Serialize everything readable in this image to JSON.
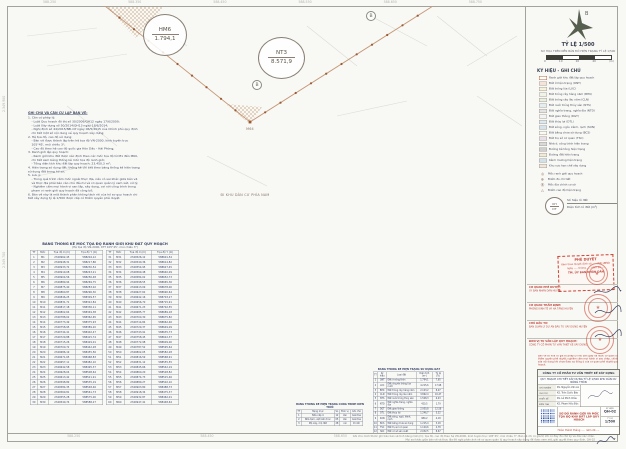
{
  "sheet": {
    "code": "QH-02"
  },
  "map": {
    "top_coords": [
      "588.250",
      "588.350",
      "588.450",
      "588.550",
      "588.650",
      "588.750"
    ],
    "bottom_coords": [
      "588.250",
      "588.450",
      "588.650"
    ],
    "left_coords": [
      "2.349.900",
      "2.349.700"
    ],
    "lots": [
      {
        "id": "HM6",
        "area": "1.794,1"
      },
      {
        "id": "NT3",
        "area": "8.571,9"
      }
    ],
    "vertex_label": "M64",
    "benchmark_label": "B",
    "road_label": "ĐI KHU DÂN CƯ PHÍA NAM"
  },
  "notes": {
    "title": "GHI CHÚ VÀ CĂN CỨ LẬP BẢN VẼ:",
    "lines": [
      {
        "text": "1. Căn cứ pháp lý:",
        "pad": "0px"
      },
      {
        "text": "- Luật Quy hoạch đô thị số 30/2009/QH12 ngày 17/6/2009;",
        "pad": "7px"
      },
      {
        "text": "- Luật Xây dựng số 50/2014/QH13 ngày 18/6/2014;",
        "pad": "7px"
      },
      {
        "text": "- Nghị định số 44/2015/NĐ-CP ngày 06/5/2015 của Chính phủ quy định chi tiết một số nội dung về quy hoạch xây dựng;",
        "pad": "7px"
      },
      {
        "text": "2. Hệ tọa độ, cao độ sử dụng:",
        "pad": "0px"
      },
      {
        "text": "- Bản vẽ được thành lập trên hệ tọa độ VN-2000, kinh tuyến trục 105°45', múi chiếu 3°;",
        "pad": "7px"
      },
      {
        "text": "- Cao độ theo hệ cao độ quốc gia Hòn Dấu - Hải Phòng;",
        "pad": "7px"
      },
      {
        "text": "3. Ranh giới lập quy hoạch:",
        "pad": "0px"
      },
      {
        "text": "- Ranh giới khu đất được xác định theo các mốc tọa độ từ M1 đến M60, chi tiết xem bảng thống kê mốc tọa độ ranh giới;",
        "pad": "7px"
      },
      {
        "text": "- Tổng diện tích khu đất lập quy hoạch: 23.450,3 m²;",
        "pad": "7px"
      },
      {
        "text": "4. Hiện trạng sử dụng đất: thống kê chi tiết theo bảng thống kê hiện trạng sử dụng đất trong hồ sơ;",
        "pad": "0px"
      },
      {
        "text": "5. Lưu ý:",
        "pad": "0px"
      },
      {
        "text": "- Trong quá trình cắm mốc ngoài thực địa, nếu có sai khác giữa bản vẽ và thực địa phải báo cáo chủ đầu tư và cơ quan quản lý xem xét, xử lý;",
        "pad": "7px"
      },
      {
        "text": "- Nghiêm cấm mọi hành vi san lấp, xây dựng, cơi nới công trình trong phạm vi ranh giới quy hoạch đã công bố;",
        "pad": "7px"
      },
      {
        "text": "6. Bản vẽ này là một thành phần không tách rời của hồ sơ quy hoạch chi tiết xây dựng tỷ lệ 1/500 được cấp có thẩm quyền phê duyệt.",
        "pad": "0px"
      }
    ]
  },
  "coord_table": {
    "title": "BẢNG THỐNG KÊ MỐC TỌA ĐỘ RANH GIỚI KHU ĐẤT QUY HOẠCH",
    "subtitle": "(Hệ tọa độ VN-2000, KTT 105°45', múi chiếu 3°)",
    "headers": [
      "TT",
      "Mốc",
      "Tọa độ X (m)",
      "Tọa độ Y (m)"
    ],
    "left": [
      [
        "1",
        "M1",
        "2349962,45",
        "588204,12"
      ],
      [
        "2",
        "M2",
        "2349948,31",
        "588217,86"
      ],
      [
        "3",
        "M3",
        "2349933,72",
        "588230,54"
      ],
      [
        "4",
        "M4",
        "2349919,08",
        "588243,21"
      ],
      [
        "5",
        "M5",
        "2349904,56",
        "588256,48"
      ],
      [
        "6",
        "M6",
        "2349889,94",
        "588269,75"
      ],
      [
        "7",
        "M7",
        "2349875,40",
        "588283,02"
      ],
      [
        "8",
        "M8",
        "2349860,87",
        "588296,30"
      ],
      [
        "9",
        "M9",
        "2349846,25",
        "588309,57"
      ],
      [
        "10",
        "M10",
        "2349831,71",
        "588322,84"
      ],
      [
        "11",
        "M11",
        "2349817,18",
        "588336,11"
      ],
      [
        "12",
        "M12",
        "2349802,64",
        "588349,38"
      ],
      [
        "13",
        "M13",
        "2349788,02",
        "588362,65"
      ],
      [
        "14",
        "M14",
        "2349773,49",
        "588375,93"
      ],
      [
        "15",
        "M15",
        "2349758,95",
        "588389,20"
      ],
      [
        "16",
        "M16",
        "2349744,41",
        "588402,47"
      ],
      [
        "17",
        "M17",
        "2349729,88",
        "588415,74"
      ],
      [
        "18",
        "M18",
        "2349715,26",
        "588429,01"
      ],
      [
        "19",
        "M19",
        "2349700,72",
        "588442,28"
      ],
      [
        "20",
        "M20",
        "2349686,19",
        "588455,56"
      ],
      [
        "21",
        "M21",
        "2349671,65",
        "588468,83"
      ],
      [
        "22",
        "M22",
        "2349657,11",
        "588482,10"
      ],
      [
        "23",
        "M23",
        "2349642,58",
        "588495,37"
      ],
      [
        "24",
        "M24",
        "2349628,04",
        "588508,64"
      ],
      [
        "25",
        "M25",
        "2349613,42",
        "588521,91"
      ],
      [
        "26",
        "M26",
        "2349598,89",
        "588535,19"
      ],
      [
        "27",
        "M27",
        "2349584,35",
        "588548,46"
      ],
      [
        "28",
        "M28",
        "2349569,81",
        "588561,73"
      ],
      [
        "29",
        "M29",
        "2349555,28",
        "588575,00"
      ],
      [
        "30",
        "M30",
        "2349540,74",
        "588588,27"
      ]
    ],
    "right": [
      [
        "31",
        "M31",
        "2349526,12",
        "588601,54"
      ],
      [
        "32",
        "M32",
        "2349540,36",
        "588614,82"
      ],
      [
        "33",
        "M33",
        "2349554,95",
        "588627,45"
      ],
      [
        "34",
        "M34",
        "2349569,48",
        "588640,09"
      ],
      [
        "35",
        "M35",
        "2349584,02",
        "588652,73"
      ],
      [
        "36",
        "M36",
        "2349598,55",
        "588665,36"
      ],
      [
        "37",
        "M37",
        "2349613,09",
        "588678,00"
      ],
      [
        "38",
        "M38",
        "2349627,62",
        "588690,64"
      ],
      [
        "39",
        "M39",
        "2349642,16",
        "588703,27"
      ],
      [
        "40",
        "M40",
        "2349656,70",
        "588715,91"
      ],
      [
        "41",
        "M41",
        "2349671,23",
        "588702,55"
      ],
      [
        "42",
        "M42",
        "2349685,77",
        "588689,18"
      ],
      [
        "43",
        "M43",
        "2349700,30",
        "588675,82"
      ],
      [
        "44",
        "M44",
        "2349714,84",
        "588662,46"
      ],
      [
        "45",
        "M45",
        "2349729,37",
        "588649,09"
      ],
      [
        "46",
        "M46",
        "2349743,91",
        "588635,73"
      ],
      [
        "47",
        "M47",
        "2349758,45",
        "588622,37"
      ],
      [
        "48",
        "M48",
        "2349772,98",
        "588609,00"
      ],
      [
        "49",
        "M49",
        "2349787,52",
        "588595,64"
      ],
      [
        "50",
        "M50",
        "2349802,05",
        "588582,28"
      ],
      [
        "51",
        "M51",
        "2349816,59",
        "588568,91"
      ],
      [
        "52",
        "M52",
        "2349831,12",
        "588555,55"
      ],
      [
        "53",
        "M53",
        "2349845,66",
        "588542,19"
      ],
      [
        "54",
        "M54",
        "2349860,20",
        "588528,82"
      ],
      [
        "55",
        "M55",
        "2349874,73",
        "588515,46"
      ],
      [
        "56",
        "M56",
        "2349889,27",
        "588502,10"
      ],
      [
        "57",
        "M57",
        "2349903,80",
        "588488,73"
      ],
      [
        "58",
        "M58",
        "2349918,34",
        "588475,37"
      ],
      [
        "59",
        "M59",
        "2349932,87",
        "588462,01"
      ],
      [
        "60",
        "M60",
        "2349947,41",
        "588448,64"
      ]
    ]
  },
  "structures_table": {
    "title": "BẢNG THỐNG KÊ HIỆN TRẠNG CÔNG TRÌNH KIẾN TRÚC",
    "headers": [
      "TT",
      "Hạng mục",
      "SL",
      "Đơn vị",
      "Ghi chú"
    ],
    "rows": [
      [
        "1",
        "Nhà cấp 4",
        "12",
        "căn",
        "Giải tỏa"
      ],
      [
        "2",
        "Nhà tạm, vật kiến trúc",
        "05",
        "căn",
        "Giải tỏa"
      ],
      [
        "3",
        "Mộ xây, mộ đất",
        "28",
        "cái",
        "Di dời"
      ]
    ]
  },
  "landuse_table": {
    "title": "BẢNG THỐNG KÊ HIỆN TRẠNG SỬ DỤNG ĐẤT",
    "headers": [
      "TT",
      "Ký hiệu",
      "Loại đất",
      "Diện tích (m²)",
      "Tỷ lệ (%)"
    ],
    "rows": [
      [
        "1",
        "ONT",
        "Đất ở nông thôn",
        "1.794,1",
        "7,65"
      ],
      [
        "2",
        "LUC",
        "Đất chuyên trồng lúa nước",
        "4.215,6",
        "17,98"
      ],
      [
        "3",
        "BHK",
        "Đất trồng cây hàng năm",
        "2.103,2",
        "8,97"
      ],
      [
        "4",
        "CLN",
        "Đất trồng cây lâu năm",
        "3.862,4",
        "16,47"
      ],
      [
        "5",
        "NTS",
        "Đất nuôi trồng thủy sản",
        "1.508,3",
        "6,43"
      ],
      [
        "6",
        "NTD",
        "Đất nghĩa trang, nghĩa địa",
        "420,5",
        "1,79"
      ],
      [
        "7",
        "DGT",
        "Đất giao thông",
        "2.950,8",
        "12,58"
      ],
      [
        "8",
        "DTL",
        "Đất thủy lợi",
        "1.246,7",
        "5,32"
      ],
      [
        "9",
        "SON",
        "Đất sông, ngòi, kênh, rạch",
        "980,2",
        "4,18"
      ],
      [
        "10",
        "BCS",
        "Đất bằng chưa sử dụng",
        "1.215,4",
        "5,18"
      ],
      [
        "11",
        "TSC",
        "Đất trụ sở cơ quan",
        "1.120,6",
        "4,78"
      ],
      [
        "12",
        "SKC",
        "Đất cơ sở sản xuất",
        "2.032,5",
        "8,67"
      ]
    ],
    "total": [
      "",
      "",
      "TỔNG CỘNG",
      "23.450,3",
      "100,00"
    ]
  },
  "panel": {
    "north_label": "B",
    "scale_title": "TỶ LỆ 1/500",
    "scale_note": "SƠ HỌA TRÊN NỀN BẢN ĐỒ HIỆN TRẠNG TỶ LỆ 1/500",
    "scale_ticks": [
      "0",
      "10",
      "20",
      "40"
    ],
    "scale_unit": "(m)",
    "legend_title": "KÝ HIỆU - GHI CHÚ",
    "legend_items": [
      {
        "t": "Ranh giới khu đất lập quy hoạch",
        "c": "#ffffff",
        "bc": "#b5643c"
      },
      {
        "t": "Đất ở hiện trạng (ONT)",
        "c": "#f6e3d7"
      },
      {
        "t": "Đất trồng lúa (LUC)",
        "c": "#f5f2dc"
      },
      {
        "t": "Đất trồng cây hàng năm (BHK)",
        "c": "#f0f4e6"
      },
      {
        "t": "Đất trồng cây lâu năm (CLN)",
        "c": "#e9f0e2"
      },
      {
        "t": "Đất nuôi trồng thủy sản (NTS)",
        "c": "#e2eef2"
      },
      {
        "t": "Đất nghĩa trang, nghĩa địa (NTD)",
        "c": "#e4e4e4"
      },
      {
        "t": "Đất giao thông (DGT)",
        "c": "#f3f3f3"
      },
      {
        "t": "Đất thủy lợi (DTL)",
        "c": "#dce9f0"
      },
      {
        "t": "Đất sông, ngòi, kênh, rạch (SON)",
        "c": "#d3e4ee"
      },
      {
        "t": "Đất bằng chưa sử dụng (BCS)",
        "c": "#fafaf3"
      },
      {
        "t": "Đất trụ sở cơ quan (TSC)",
        "c": "#eadfe9"
      },
      {
        "t": "Nhà ở, công trình hiện trạng",
        "c": "#d9d9d9"
      },
      {
        "t": "Đường bê tông hiện trạng",
        "c": "#cfcfcf"
      },
      {
        "t": "Đường đất hiện trạng",
        "c": "#f1ead8"
      },
      {
        "t": "Kênh mương hiện trạng",
        "c": "#cfe2ea"
      },
      {
        "t": "Khu vực hạn chế xây dựng",
        "c": "#f0e6da"
      }
    ],
    "legend_symbols": [
      {
        "g": "◎",
        "t": "Mốc ranh giới quy hoạch"
      },
      {
        "g": "⊕",
        "t": "Điểm đo chi tiết"
      },
      {
        "g": "Ⓑ",
        "t": "Mốc địa chính cơ sở"
      },
      {
        "g": "△",
        "t": "Điểm cao độ hiện trạng"
      }
    ],
    "lot_symbol": {
      "top": "KH",
      "bottom": "DT",
      "label_top": "Số hiệu lô đất",
      "label_bottom": "Diện tích lô đất (m²)"
    },
    "stamp_box": {
      "line1": "PHÊ DUYỆT",
      "line2": "Kèm theo Quyết định số ....../QĐ-UBND",
      "line3": "ngày ..... tháng ..... năm 20.....",
      "line4": "TM. ỦY BAN NHÂN DÂN"
    },
    "signatures": [
      {
        "role": "CƠ QUAN PHÊ DUYỆT:",
        "org": "ỦY BAN NHÂN DÂN HUYỆN"
      },
      {
        "role": "CƠ QUAN THẨM ĐỊNH:",
        "org": "PHÒNG KINH TẾ VÀ HẠ TẦNG HUYỆN"
      },
      {
        "role": "CHỦ ĐẦU TƯ:",
        "org": "BAN QUẢN LÝ DỰ ÁN ĐẦU TƯ XÂY DỰNG HUYỆN"
      },
      {
        "role": "ĐƠN VỊ TƯ VẤN LẬP QUY HOẠCH:",
        "org": "CÔNG TY CỔ PHẦN TƯ VẤN THIẾT KẾ XÂY DỰNG"
      }
    ],
    "legal_note": "Bản vẽ số hóa có giá trị pháp lý như bản giấy đã được cơ quan có thẩm quyền phê duyệt; nghiêm cấm mọi hành vi sao chép, chỉnh sửa nội dung khi chưa được sự đồng ý của cơ quan phê duyệt quy hoạch.",
    "title_block": {
      "company": "CÔNG TY CỔ PHẦN TƯ VẤN THIẾT KẾ XÂY DỰNG",
      "project": "QUY HOẠCH CHI TIẾT XÂY DỰNG TỶ LỆ 1/500 KHU DÂN CƯ NÔNG THÔN",
      "roles": [
        {
          "l": "CHỦ NHIỆM",
          "n": "KS. Nguyễn Văn An"
        },
        {
          "l": "CHỦ TRÌ",
          "n": "KS. Trần Quốc Bảo"
        },
        {
          "l": "THIẾT KẾ",
          "n": "KS. Lê Minh Châu"
        },
        {
          "l": "KIỂM TRA",
          "n": "KS. Phạm Hữu Đức"
        }
      ],
      "drawing_title": "SƠ ĐỒ RANH GIỚI VÀ MỐC TỌA ĐỘ KHU ĐẤT LẬP QUY HOẠCH",
      "sheet_label": "KÝ HIỆU",
      "sheet_code": "QH-02",
      "scale_label": "TỶ LỆ",
      "scale_value": "1/500",
      "date_line": "Hoàn thành tháng ..... năm 20....."
    },
    "footer_line1": "Ghi chú: Kích thước ghi trên bản vẽ tính bằng mét (m); tọa độ, cao độ theo hệ VN-2000, kinh tuyến trục 105°45', múi chiếu 3°. Bản vẽ chỉ có giá trị khi có đầy đủ chữ ký và dấu xác nhận.",
    "footer_line2": "Mọi sai khác giữa bản vẽ và thực địa đề nghị phản ánh về cơ quan quản lý quy hoạch xây dựng để được xem xét, giải quyết theo quy định.   QH-02"
  }
}
